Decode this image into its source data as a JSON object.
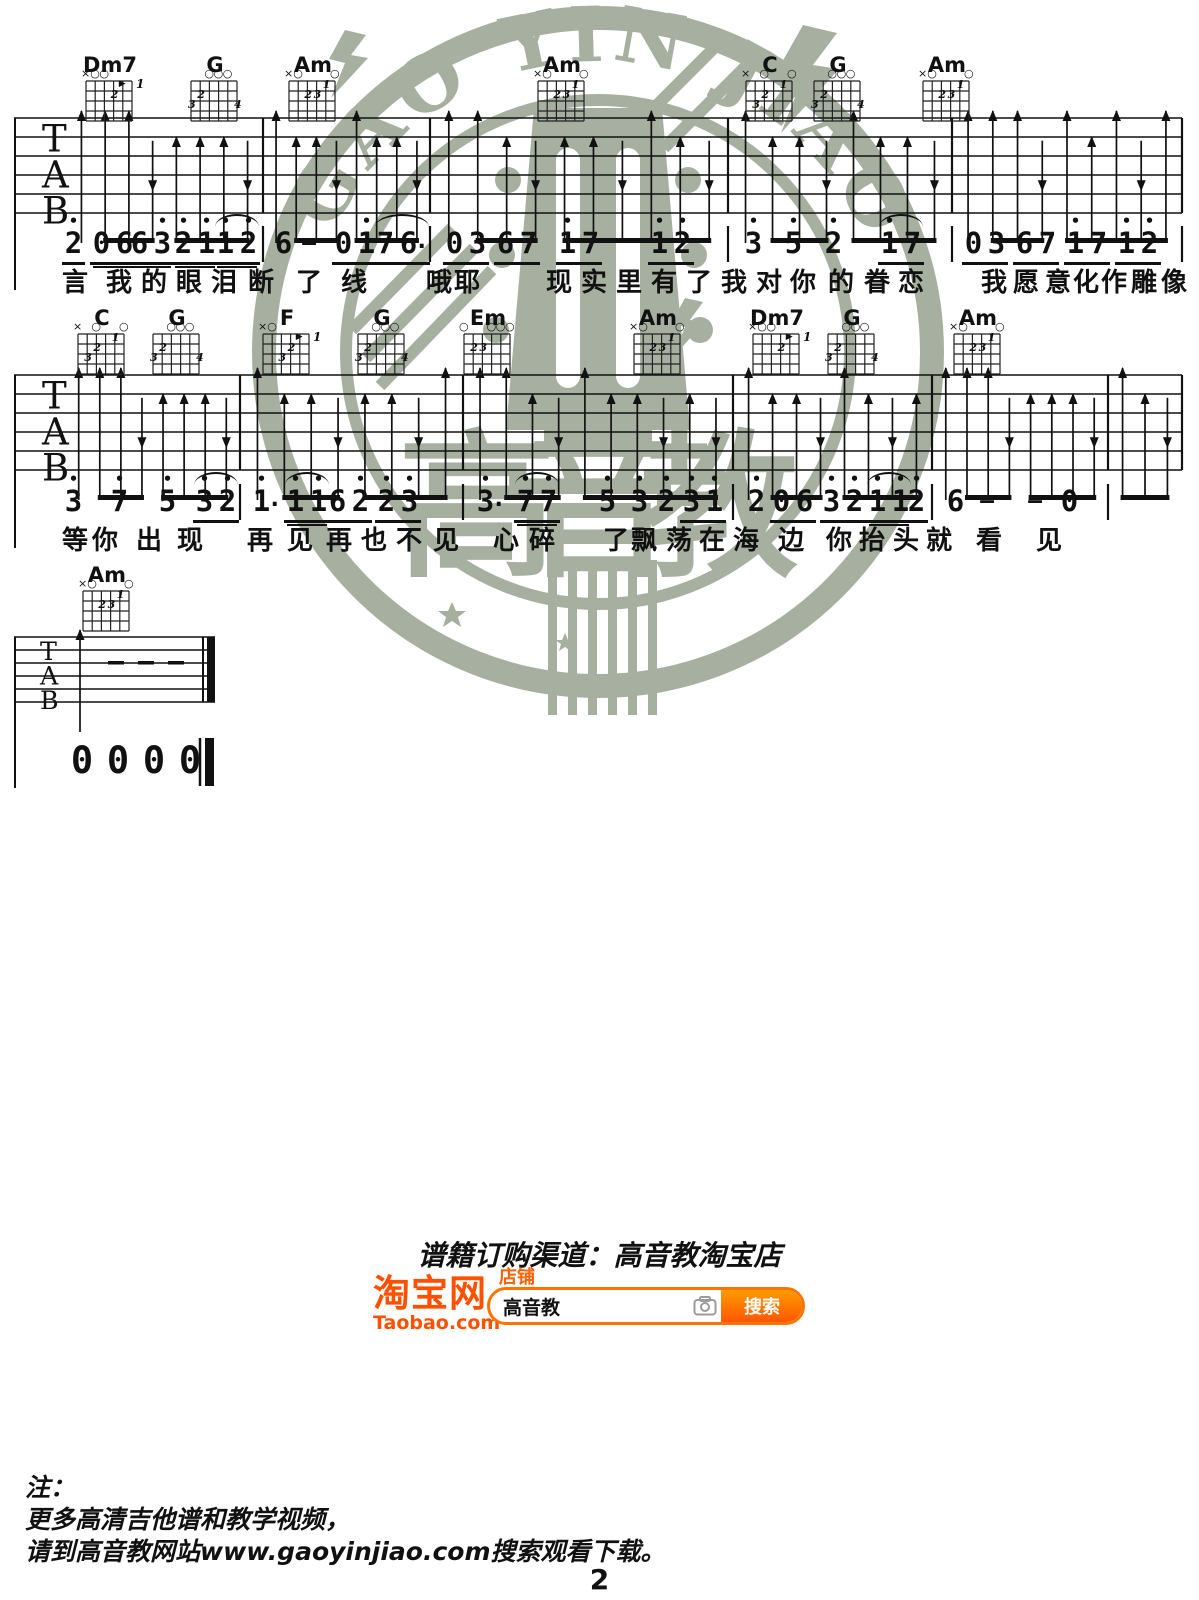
{
  "page_number": "2",
  "watermark": {
    "arc_text": "GAO YIN JIAO",
    "brand": "高音教",
    "color": "#a7b0a0"
  },
  "order_section": {
    "title": "谱籍订购渠道：高音教淘宝店",
    "taobao_logo": "淘宝网",
    "taobao_domain": "Taobao.com",
    "shop_label": "店铺",
    "search_value": "高音教",
    "search_button": "搜索",
    "orange": "#ff5000"
  },
  "footer_note": {
    "label": "注：",
    "line1": "更多高清吉他谱和教学视频，",
    "line2": "请到高音教网站www.gaoyinjiao.com搜索观看下载。"
  },
  "tab_letters": [
    "T",
    "A",
    "B"
  ],
  "chord_shapes": {
    "Dm7": {
      "markers": [
        "x",
        "o",
        "o",
        "",
        "",
        ""
      ],
      "fingers": [
        [
          3,
          2,
          "2"
        ]
      ],
      "barre": [
        4,
        1,
        "1"
      ]
    },
    "G": {
      "markers": [
        "",
        "",
        "o",
        "o",
        "o",
        ""
      ],
      "fingers": [
        [
          0,
          3,
          "3"
        ],
        [
          1,
          2,
          "2"
        ],
        [
          5,
          3,
          "4"
        ]
      ]
    },
    "Am": {
      "markers": [
        "x",
        "o",
        "",
        "",
        "",
        "o"
      ],
      "fingers": [
        [
          4,
          1,
          "1"
        ],
        [
          2,
          2,
          "2"
        ],
        [
          3,
          2,
          "3"
        ]
      ]
    },
    "C": {
      "markers": [
        "x",
        "",
        "o",
        "",
        "",
        "o"
      ],
      "fingers": [
        [
          4,
          1,
          "1"
        ],
        [
          2,
          2,
          "2"
        ],
        [
          1,
          3,
          "3"
        ]
      ]
    },
    "F": {
      "markers": [
        "x",
        "o",
        "",
        "",
        "",
        ""
      ],
      "fingers": [
        [
          3,
          2,
          "2"
        ],
        [
          2,
          3,
          "3"
        ]
      ],
      "barre": [
        4,
        1,
        "1"
      ]
    },
    "Em": {
      "markers": [
        "o",
        "",
        "",
        "o",
        "o",
        "o"
      ],
      "fingers": [
        [
          1,
          2,
          "2"
        ],
        [
          2,
          2,
          "3"
        ]
      ]
    }
  },
  "systems": [
    {
      "staff": {
        "top": 118,
        "gap": 19,
        "left": 14,
        "right": 1182,
        "bars": [
          263,
          430,
          728,
          952,
          1182
        ]
      },
      "left_line_bottom": 290,
      "num_y": 228,
      "lyr_y": 262,
      "nbars": [
        263,
        430,
        728,
        952,
        1182
      ],
      "chords": [
        {
          "name": "Dm7",
          "type": "Dm7",
          "x": 85,
          "y": 55
        },
        {
          "name": "G",
          "type": "G",
          "x": 190,
          "y": 55
        },
        {
          "name": "Am",
          "type": "Am",
          "x": 288,
          "y": 55
        },
        {
          "name": "Am",
          "type": "Am",
          "x": 537,
          "y": 55
        },
        {
          "name": "C",
          "type": "C",
          "x": 745,
          "y": 55
        },
        {
          "name": "G",
          "type": "G",
          "x": 813,
          "y": 55
        },
        {
          "name": "Am",
          "type": "Am",
          "x": 922,
          "y": 55
        }
      ],
      "measures": [
        {
          "x0": 66,
          "x1": 263,
          "strum": "UUUduuud"
        },
        {
          "x0": 263,
          "x1": 430,
          "strum": "UuudUuud"
        },
        {
          "x0": 430,
          "x1": 728,
          "strum": "UUuduudUud"
        },
        {
          "x0": 728,
          "x1": 952,
          "strum": "UuudUuud"
        },
        {
          "x0": 952,
          "x1": 1182,
          "strum": "UUUdUuUdU"
        }
      ],
      "groups": [
        {
          "x": 62,
          "u": 1,
          "tokens": [
            "2'"
          ]
        },
        {
          "x": 90,
          "u": 2,
          "tokens": [
            "0",
            "6"
          ]
        },
        {
          "x": 128,
          "u": 2,
          "tokens": [
            "6",
            "3'"
          ]
        },
        {
          "x": 172,
          "u": 2,
          "tokens": [
            "2'",
            "1'"
          ]
        },
        {
          "x": 214,
          "u": 2,
          "tie": 1,
          "tokens": [
            "1'",
            "2'"
          ]
        },
        {
          "x": 272,
          "tokens": [
            "6"
          ]
        },
        {
          "x": 294,
          "tokens": [
            "—"
          ]
        },
        {
          "x": 332,
          "u": 1,
          "tokens": [
            "0",
            "1'"
          ]
        },
        {
          "x": 374,
          "u": 1,
          "tie": 1,
          "tokens": [
            "7",
            "6*"
          ]
        },
        {
          "x": 443,
          "u": 1,
          "tokens": [
            "0",
            "3"
          ]
        },
        {
          "x": 494,
          "u": 1,
          "tokens": [
            "6",
            "7"
          ]
        },
        {
          "x": 556,
          "u": 1,
          "tokens": [
            "1'",
            "7"
          ]
        },
        {
          "x": 648,
          "u": 1,
          "tokens": [
            "1'",
            "2'"
          ]
        },
        {
          "x": 742,
          "tokens": [
            "3'"
          ]
        },
        {
          "x": 782,
          "tokens": [
            "5'"
          ]
        },
        {
          "x": 822,
          "tokens": [
            "2'"
          ]
        },
        {
          "x": 878,
          "u": 1,
          "tie": 1,
          "tokens": [
            "1'",
            "7"
          ]
        },
        {
          "x": 962,
          "u": 1,
          "tokens": [
            "0",
            "3"
          ]
        },
        {
          "x": 1013,
          "u": 1,
          "tokens": [
            "6",
            "7"
          ]
        },
        {
          "x": 1064,
          "u": 1,
          "tokens": [
            "1'",
            "7"
          ]
        },
        {
          "x": 1115,
          "u": 1,
          "tokens": [
            "1'",
            "2'"
          ]
        }
      ],
      "lyrics": [
        [
          "言",
          62
        ],
        [
          "我",
          106
        ],
        [
          "的",
          141
        ],
        [
          "眼",
          176
        ],
        [
          "泪",
          211
        ],
        [
          "断",
          248
        ],
        [
          "了",
          296
        ],
        [
          "线",
          341
        ],
        [
          "哦",
          426
        ],
        [
          "耶",
          454
        ],
        [
          "现",
          546
        ],
        [
          "实",
          581
        ],
        [
          "里",
          616
        ],
        [
          "有",
          651
        ],
        [
          "了",
          686
        ],
        [
          "我",
          721
        ],
        [
          "对",
          756
        ],
        [
          "你",
          790
        ],
        [
          "的",
          828
        ],
        [
          "眷",
          864
        ],
        [
          "恋",
          898
        ],
        [
          "我",
          981
        ],
        [
          "愿",
          1013
        ],
        [
          "意",
          1045
        ],
        [
          "化",
          1073
        ],
        [
          "作",
          1101
        ],
        [
          "雕",
          1131
        ],
        [
          "像",
          1161
        ]
      ]
    },
    {
      "staff": {
        "top": 375,
        "gap": 19,
        "left": 14,
        "right": 1182,
        "bars": [
          240,
          463,
          733,
          932,
          1108,
          1182
        ]
      },
      "left_line_bottom": 548,
      "num_y": 486,
      "lyr_y": 520,
      "nbars": [
        240,
        463,
        733,
        932,
        1108
      ],
      "chords": [
        {
          "name": "C",
          "type": "C",
          "x": 77,
          "y": 308
        },
        {
          "name": "G",
          "type": "G",
          "x": 152,
          "y": 308
        },
        {
          "name": "F",
          "type": "F",
          "x": 262,
          "y": 308
        },
        {
          "name": "G",
          "type": "G",
          "x": 357,
          "y": 308
        },
        {
          "name": "Em",
          "type": "Em",
          "x": 463,
          "y": 308
        },
        {
          "name": "Am",
          "type": "Am",
          "x": 633,
          "y": 308
        },
        {
          "name": "Dm7",
          "type": "Dm7",
          "x": 752,
          "y": 308
        },
        {
          "name": "G",
          "type": "G",
          "x": 827,
          "y": 308
        },
        {
          "name": "Am",
          "type": "Am",
          "x": 953,
          "y": 308
        }
      ],
      "measures": [
        {
          "x0": 65,
          "x1": 240,
          "strum": "UUUduuud"
        },
        {
          "x0": 240,
          "x1": 463,
          "strum": "UuuduudU"
        },
        {
          "x0": 463,
          "x1": 733,
          "strum": "UUudUuudud"
        },
        {
          "x0": 733,
          "x1": 932,
          "strum": "UuudUudu"
        },
        {
          "x0": 932,
          "x1": 1108,
          "strum": "UUUduuud"
        },
        {
          "x0": 1108,
          "x1": 1182,
          "strum": "Uud"
        }
      ],
      "groups": [
        {
          "x": 62,
          "tokens": [
            "3'"
          ]
        },
        {
          "x": 108,
          "tokens": [
            "7'"
          ]
        },
        {
          "x": 156,
          "tokens": [
            "5'"
          ]
        },
        {
          "x": 193,
          "u": 1,
          "tie": 1,
          "tokens": [
            "3'",
            "2'"
          ]
        },
        {
          "x": 250,
          "tokens": [
            "1'*"
          ]
        },
        {
          "x": 284,
          "u": 2,
          "tie": 1,
          "tokens": [
            "1'",
            "1'"
          ]
        },
        {
          "x": 326,
          "u": 1,
          "tokens": [
            "6",
            "2'"
          ]
        },
        {
          "x": 375,
          "u": 1,
          "tokens": [
            "2'",
            "3'"
          ]
        },
        {
          "x": 474,
          "tokens": [
            "3'*"
          ]
        },
        {
          "x": 514,
          "u": 2,
          "tie": 1,
          "tokens": [
            "7'",
            "7'"
          ]
        },
        {
          "x": 596,
          "tokens": [
            "5'"
          ]
        },
        {
          "x": 628,
          "tokens": [
            "3'"
          ]
        },
        {
          "x": 655,
          "tokens": [
            "2'"
          ]
        },
        {
          "x": 680,
          "u": 1,
          "tokens": [
            "3'",
            "1'"
          ]
        },
        {
          "x": 745,
          "tokens": [
            "2'"
          ]
        },
        {
          "x": 770,
          "u": 1,
          "tokens": [
            "0",
            "6"
          ]
        },
        {
          "x": 820,
          "u": 1,
          "tokens": [
            "3'",
            "2'"
          ]
        },
        {
          "x": 866,
          "u": 2,
          "tie": 1,
          "tokens": [
            "1'",
            "1'"
          ]
        },
        {
          "x": 905,
          "u": 1,
          "tokens": [
            "2'"
          ]
        },
        {
          "x": 944,
          "tokens": [
            "6"
          ]
        },
        {
          "x": 972,
          "tokens": [
            "—"
          ]
        },
        {
          "x": 1020,
          "tokens": [
            "—"
          ]
        },
        {
          "x": 1058,
          "tokens": [
            "0"
          ]
        }
      ],
      "lyrics": [
        [
          "等",
          62
        ],
        [
          "你",
          92
        ],
        [
          "出",
          136
        ],
        [
          "现",
          177
        ],
        [
          "再",
          247
        ],
        [
          "见",
          287
        ],
        [
          "再",
          326
        ],
        [
          "也",
          361
        ],
        [
          "不",
          396
        ],
        [
          "见",
          433
        ],
        [
          "心",
          493
        ],
        [
          "碎",
          529
        ],
        [
          "了",
          603
        ],
        [
          "飘",
          631
        ],
        [
          "荡",
          666
        ],
        [
          "在",
          699
        ],
        [
          "海",
          733
        ],
        [
          "边",
          778
        ],
        [
          "你",
          826
        ],
        [
          "抬",
          859
        ],
        [
          "头",
          893
        ],
        [
          "就",
          926
        ],
        [
          "看",
          976
        ],
        [
          "见",
          1036
        ]
      ]
    }
  ],
  "ending": {
    "staff": {
      "top": 637,
      "gap": 13,
      "left": 14,
      "right": 215,
      "bars": []
    },
    "left_line_bottom": 788,
    "chord": {
      "name": "Am",
      "type": "Am",
      "x": 82,
      "y": 565
    },
    "measures": [
      {
        "x0": 20,
        "x1": 140,
        "strum": "U"
      }
    ],
    "dashes_x": [
      108,
      138,
      168
    ],
    "num_y": 742,
    "numbers": [
      "0",
      "0",
      "0",
      "0"
    ]
  }
}
